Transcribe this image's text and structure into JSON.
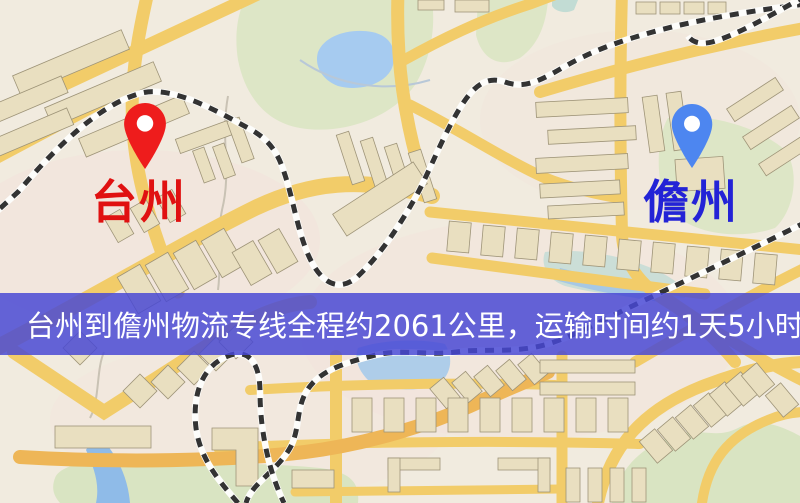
{
  "map": {
    "type": "road-map",
    "pins": {
      "origin": {
        "city": "台州",
        "pin_color": "#ee1c1c",
        "label_color": "#e01111",
        "icon": "map-pin"
      },
      "destination": {
        "city": "儋州",
        "pin_color": "#4d86f0",
        "label_color": "#2323d6",
        "icon": "map-pin"
      }
    },
    "colors": {
      "background": "#f1ebdf",
      "road": "#f2cc69",
      "road_major": "#eeb657",
      "building": "#e9dfc0",
      "park": "#dde6c6",
      "water": "#a6cbf0",
      "railway": "#333333"
    }
  },
  "banner": {
    "text": "台州到儋州物流专线全程约2061公里，运输时间约1天5小时.",
    "background_color": "#4848d4",
    "text_color": "#ffffff"
  },
  "route": {
    "origin": "台州",
    "destination": "儋州",
    "distance_km": 2061,
    "duration": "1天5小时"
  }
}
